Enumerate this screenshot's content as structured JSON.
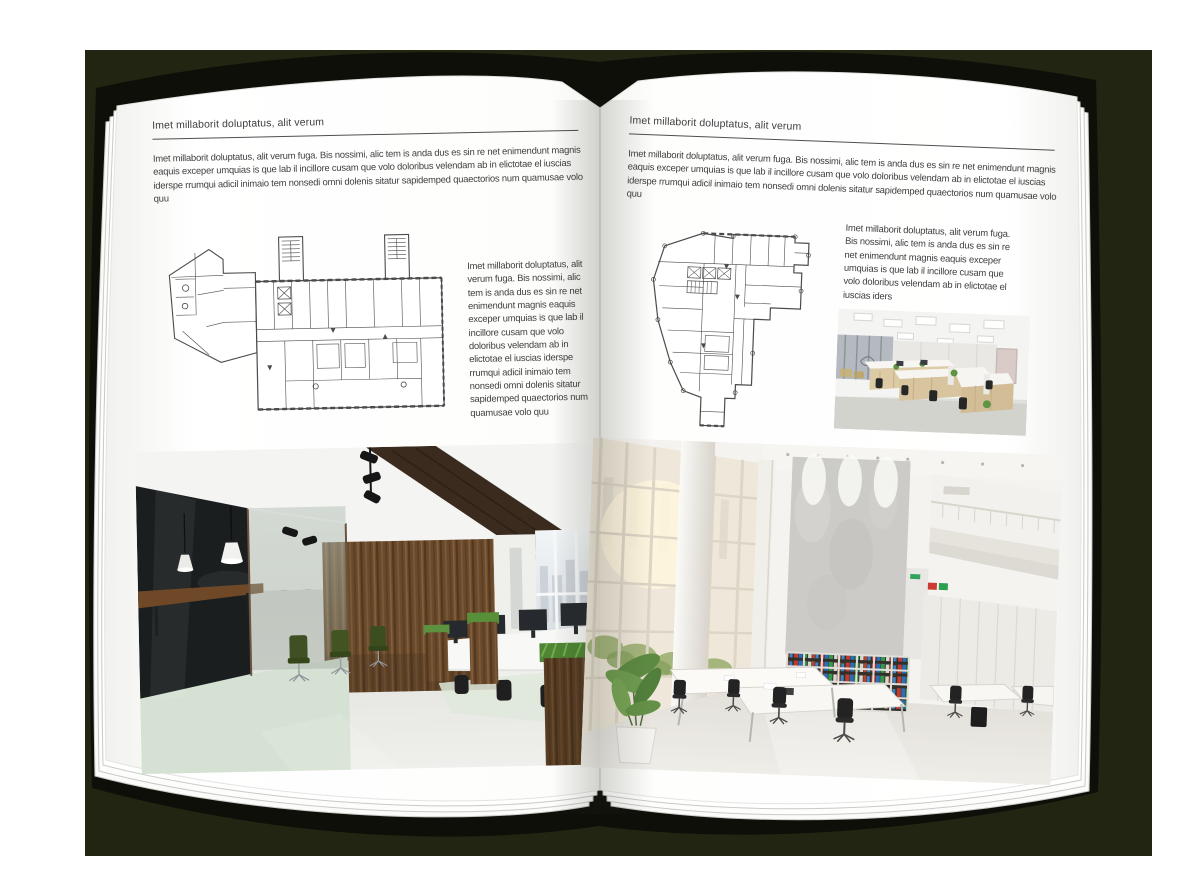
{
  "backdrop_color": "#212511",
  "book": {
    "cover_color": "#0e0f09",
    "paper_color": "#ffffff",
    "text_color": "#3e3e3e",
    "rule_color": "#4f4f4f"
  },
  "left_page": {
    "kicker": "Imet millaborit doluptatus, alit verum",
    "intro": "Imet millaborit doluptatus, alit verum fuga. Bis nossimi, alic tem is anda dus es sin re net enimendunt magnis eaquis exceper umquias is que lab il incillore cusam que volo doloribus velendam ab in elictotae el iuscias iderspe rrumqui adicil inimaio tem nonsedi omni dolenis sitatur sapidemped quaectorios num quamusae volo quu",
    "side_text": "Imet millaborit doluptatus, alit verum fuga. Bis nossimi, alic tem is anda dus es sin re net enimendunt magnis eaquis exceper umquias is que lab il incillore cusam que volo doloribus velendam ab in elictotae el iuscias iderspe rrumqui adicil inimaio tem nonsedi omni dolenis sitatur sapidemped quaectorios num quamusae volo quu",
    "floor_plan_label": "Architectural floor plan of wide office building with two stair towers",
    "photo_label": "Loft office interior with glass meeting room, green chairs and wood wall"
  },
  "right_page": {
    "kicker": "Imet millaborit doluptatus, alit verum",
    "intro": "Imet millaborit doluptatus, alit verum fuga. Bis nossimi, alic tem is anda dus es sin re net enimendunt magnis eaquis exceper umquias is que lab il incillore cusam que volo doloribus velendam ab in elictotae el iuscias iderspe rrumqui adicil inimaio tem nonsedi omni dolenis sitatur sapidemped quaectorios num quamusae volo quu",
    "side_text": "Imet millaborit doluptatus, alit verum fuga. Bis nossimi, alic tem is anda dus es sin re net enimendunt magnis eaquis exceper umquias is que lab il incillore cusam que volo doloribus velendam ab in elictotae el iuscias iders",
    "floor_plan_label": "Architectural floor plan of irregular tower floor",
    "photo_small_label": "Open-plan office workstations with light wood cabinets",
    "photo_label": "Bright double-height office atrium with tall windows and bookshelf"
  }
}
